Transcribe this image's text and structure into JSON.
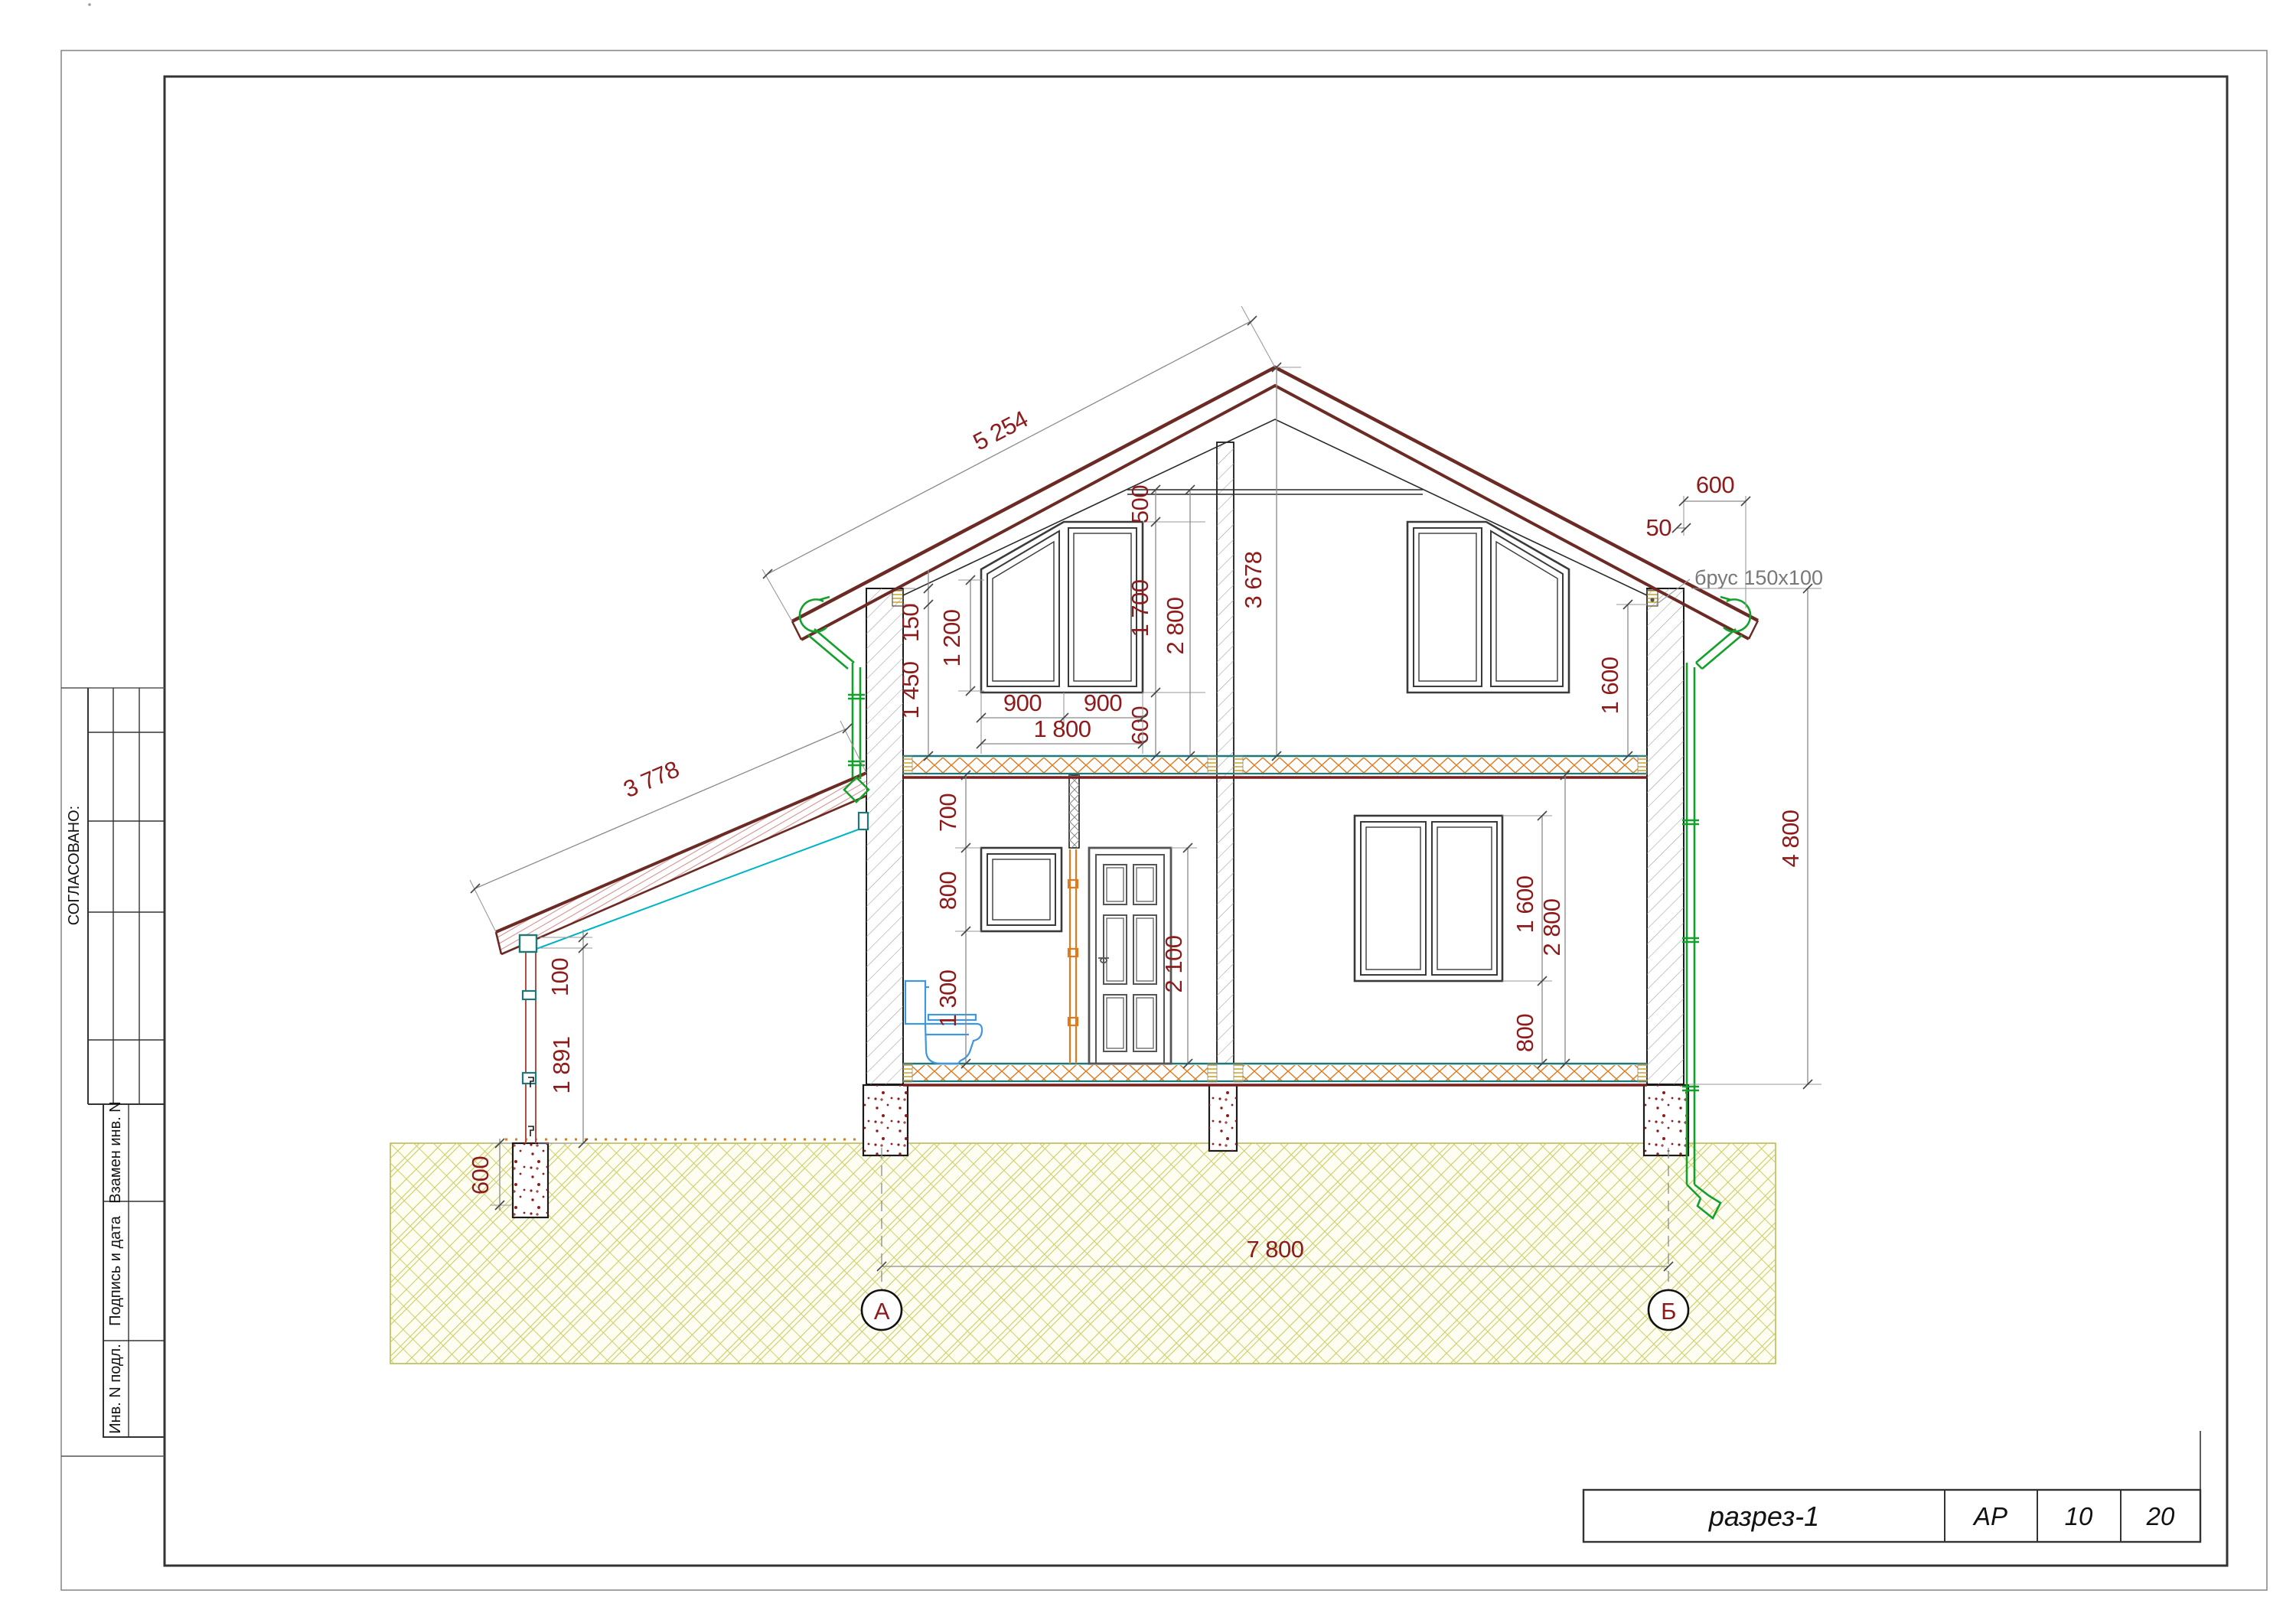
{
  "frame": {
    "agreed_label": "СОГЛАСОВАНО:",
    "stamp_rows": [
      "Взамен инв. N",
      "Подпись и дата",
      "Инв. N подл."
    ]
  },
  "title_block": {
    "drawing_title": "разрез-1",
    "stage": "АР",
    "sheet_number": "10",
    "total_sheets": "20"
  },
  "axes": {
    "left": "А",
    "right": "Б",
    "span": "7 800"
  },
  "labels": {
    "beam": "брус 150x100"
  },
  "dims": {
    "roof_slope": "5 254",
    "porch_slope": "3 778",
    "ridge_height": "3 678",
    "above_attic_window": "500",
    "attic_window_height": "1 700",
    "attic_floor_height": "2 800",
    "attic_sill": "600",
    "attic_win_w1": "900",
    "attic_win_w2": "900",
    "attic_win_total": "1 800",
    "attic_pane_height": "1 200",
    "wall_beam_height": "150",
    "eave_to_floor": "1 450",
    "eave_overhang": "600",
    "overhang_gap": "50",
    "attic_wall_height": "1 600",
    "right_total_height": "4 800",
    "above_small_window": "700",
    "small_window_height": "800",
    "small_window_sill": "1 300",
    "door_height": "2 100",
    "right_window_height": "1 600",
    "floor_height": "2 800",
    "right_window_sill": "800",
    "porch_post_height": "1 891",
    "porch_post_top": "100",
    "pier_depth": "600"
  },
  "colors": {
    "dim_text": "#8e1b1b",
    "roof": "#6b2a23",
    "insulation": "#e07a1e",
    "teal": "#1e7878",
    "cyan": "#00b4c8",
    "gutter_green": "#14a02c",
    "ground": "#c3c345",
    "concrete_speckle": "#8e1b1b"
  }
}
